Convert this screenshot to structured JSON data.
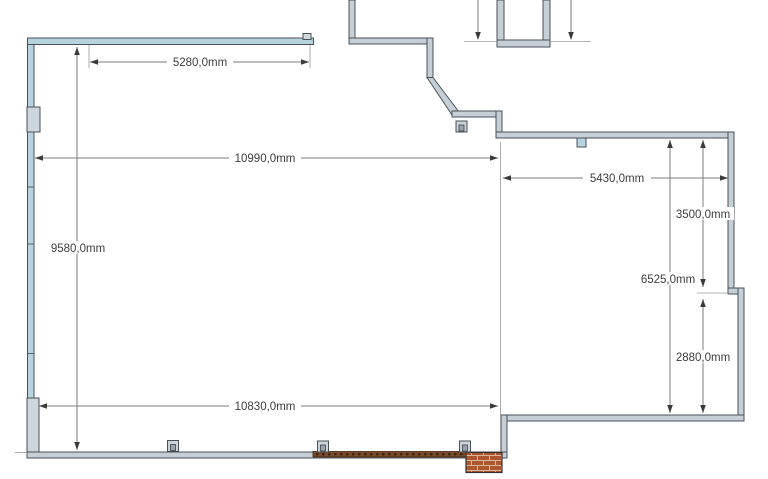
{
  "diagram": {
    "kind": "floor-plan",
    "unit_suffix": "mm"
  },
  "dimensions": {
    "d5280": {
      "label": "5280,0mm",
      "orientation": "horizontal",
      "value_mm": 5280.0
    },
    "d10990": {
      "label": "10990,0mm",
      "orientation": "horizontal",
      "value_mm": 10990.0
    },
    "d9580": {
      "label": "9580,0mm",
      "orientation": "vertical",
      "value_mm": 9580.0
    },
    "d10830": {
      "label": "10830,0mm",
      "orientation": "horizontal",
      "value_mm": 10830.0
    },
    "d5430": {
      "label": "5430,0mm",
      "orientation": "horizontal",
      "value_mm": 5430.0
    },
    "d3500": {
      "label": "3500,0mm",
      "orientation": "vertical",
      "value_mm": 3500.0
    },
    "d6525": {
      "label": "6525,0mm",
      "orientation": "vertical",
      "value_mm": 6525.0
    },
    "d2880": {
      "label": "2880,0mm",
      "orientation": "vertical",
      "value_mm": 2880.0
    }
  },
  "colors": {
    "background": "#ffffff",
    "wall_blue": "#b7d3df",
    "wall_gray": "#c6cfd6",
    "wall_stroke": "#4a5258",
    "dim_line": "#7d7d7d",
    "dim_text": "#3d3d3d",
    "arrow": "#3a3a3a",
    "wood": "#7b4a28",
    "brick": "#ad5730",
    "mortar": "#d9b89a"
  }
}
